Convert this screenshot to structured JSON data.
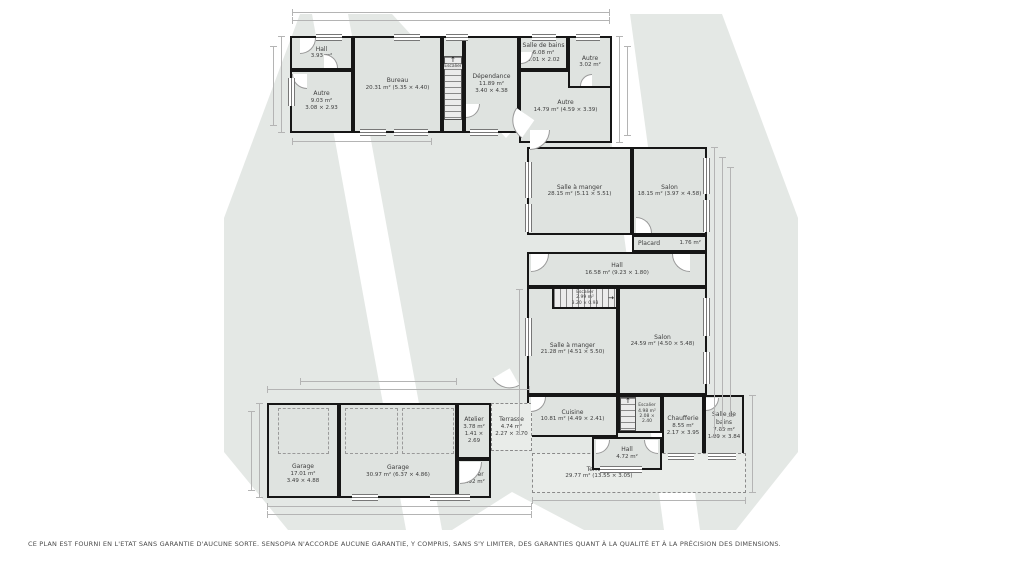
{
  "rooms": {
    "hall_top": {
      "name": "Hall",
      "area": "3.93 m²"
    },
    "autre_9": {
      "name": "Autre",
      "area": "9.03 m²",
      "dims": "3.08 × 2.93"
    },
    "bureau": {
      "name": "Bureau",
      "area": "20.31 m² (5.35 × 4.40)"
    },
    "escalier_top": {
      "name": "Escalier"
    },
    "dependance": {
      "name": "Dépendance",
      "area": "11.89 m²",
      "dims": "3.40 × 4.38"
    },
    "sdb_top": {
      "name": "Salle de bains",
      "area": "6.08 m²",
      "dims": "3.01 × 2.02"
    },
    "autre_3": {
      "name": "Autre",
      "area": "3.02 m²"
    },
    "autre_14": {
      "name": "Autre",
      "area": "14.79 m² (4.59 × 3.39)"
    },
    "sam_28": {
      "name": "Salle à manger",
      "area": "28.15 m² (5.11 × 5.51)"
    },
    "salon_18": {
      "name": "Salon",
      "area": "18.15 m² (3.97 × 4.58)"
    },
    "placard": {
      "name": "Placard",
      "area": "1.76 m²"
    },
    "hall_16": {
      "name": "Hall",
      "area": "16.58 m² (9.23 × 1.80)"
    },
    "escalier_mid": {
      "name": "Escalier",
      "area": "2.99 m²",
      "dims": "3.20 × 0.93"
    },
    "sam_21": {
      "name": "Salle à manger",
      "area": "21.28 m² (4.51 × 5.50)"
    },
    "salon_24": {
      "name": "Salon",
      "area": "24.59 m² (4.50 × 5.48)"
    },
    "cuisine": {
      "name": "Cuisine",
      "area": "10.81 m² (4.49 × 2.41)"
    },
    "escalier_low": {
      "name": "Escalier",
      "area": "4.98 m²",
      "dims": "2.08 × 2.40"
    },
    "chaufferie": {
      "name": "Chaufferie",
      "area": "8.55 m²",
      "dims": "2.17 × 3.95"
    },
    "sdb_low": {
      "name": "Salle de bains",
      "area": "7.65 m²",
      "dims": "1.99 × 3.84"
    },
    "hall_4": {
      "name": "Hall",
      "area": "4.72 m²"
    },
    "terrasse_29": {
      "name": "Terrasse",
      "area": "29.77 m² (13.55 × 3.05)"
    },
    "garage_17": {
      "name": "Garage",
      "area": "17.01 m²",
      "dims": "3.49 × 4.88"
    },
    "garage_30": {
      "name": "Garage",
      "area": "30.97 m² (6.37 × 4.86)"
    },
    "atelier_3": {
      "name": "Atelier",
      "area": "3.78 m²",
      "dims": "1.41 × 2.69"
    },
    "atelier_2": {
      "name": "Atelier",
      "area": "2.92 m²"
    },
    "terrasse_4": {
      "name": "Terrasse",
      "area": "4.74 m²",
      "dims": "2.27 × 2.70"
    }
  },
  "icons": {
    "stairs_up_arrow": "↑",
    "stairs_right_arrow": "→"
  },
  "colors": {
    "wall": "#161616",
    "room_fill": "#dfe3e0",
    "watermark": "#e4e8e5",
    "dimension_line": "#b4b4b4",
    "label_text": "#3d3d3d"
  },
  "footer": {
    "disclaimer": "CE PLAN EST FOURNI EN L'ETAT SANS GARANTIE D'AUCUNE SORTE. SENSOPIA N'ACCORDE AUCUNE GARANTIE, Y COMPRIS, SANS S'Y LIMITER, DES GARANTIES QUANT À LA QUALITÉ ET À LA PRÉCISION DES DIMENSIONS."
  }
}
